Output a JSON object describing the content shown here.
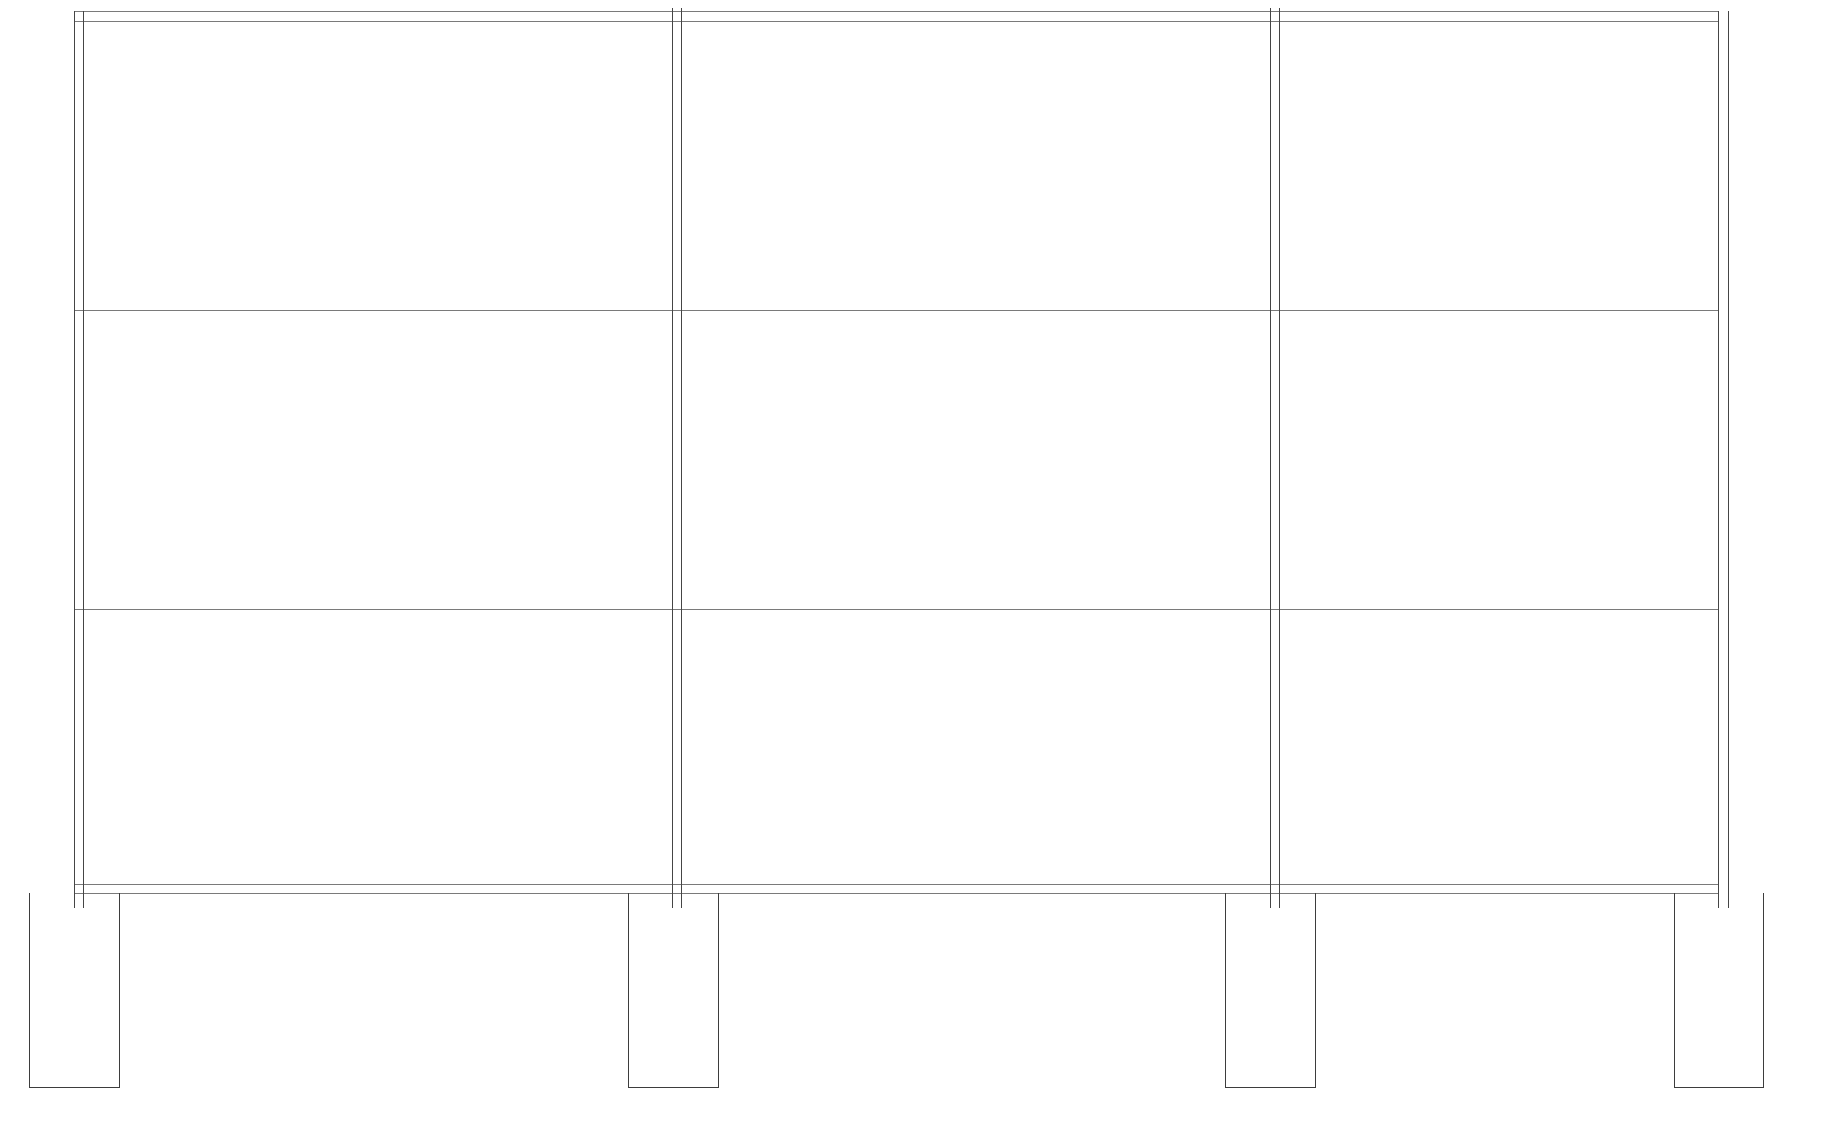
{
  "canvas": {
    "width": 1826,
    "height": 1142,
    "background_color": "#ffffff",
    "vertical_line_color": "#454545",
    "horizontal_line_color": "#7a7a7a",
    "footing_line_color": "#3d3d3d",
    "line_width": 1
  },
  "frame": {
    "columns": [
      {
        "id": "column-1",
        "x_left": 74,
        "x_right": 83,
        "y_top": 11,
        "y_bottom": 908
      },
      {
        "id": "column-2",
        "x_left": 672,
        "x_right": 681,
        "y_top": 8,
        "y_bottom": 908
      },
      {
        "id": "column-3",
        "x_left": 1270,
        "x_right": 1279,
        "y_top": 8,
        "y_bottom": 908
      },
      {
        "id": "column-4",
        "x_left": 1718,
        "x_right": 1728,
        "y_top": 11,
        "y_bottom": 908
      }
    ],
    "levels": [
      {
        "id": "roof-beam",
        "x_start": 74,
        "x_end": 1718,
        "lines_y": [
          11,
          21
        ]
      },
      {
        "id": "level-2-floor",
        "x_start": 74,
        "x_end": 1718,
        "lines_y": [
          310
        ]
      },
      {
        "id": "level-3-floor",
        "x_start": 74,
        "x_end": 1718,
        "lines_y": [
          609
        ]
      },
      {
        "id": "grade-beam",
        "x_start": 74,
        "x_end": 1718,
        "lines_y": [
          884,
          893
        ]
      }
    ],
    "footings": [
      {
        "id": "footing-1",
        "x_left": 29,
        "x_right": 119,
        "y_top": 893,
        "y_bottom": 1087
      },
      {
        "id": "footing-2",
        "x_left": 628,
        "x_right": 718,
        "y_top": 893,
        "y_bottom": 1087
      },
      {
        "id": "footing-3",
        "x_left": 1225,
        "x_right": 1315,
        "y_top": 893,
        "y_bottom": 1087
      },
      {
        "id": "footing-4",
        "x_left": 1674,
        "x_right": 1763,
        "y_top": 893,
        "y_bottom": 1087
      }
    ]
  }
}
